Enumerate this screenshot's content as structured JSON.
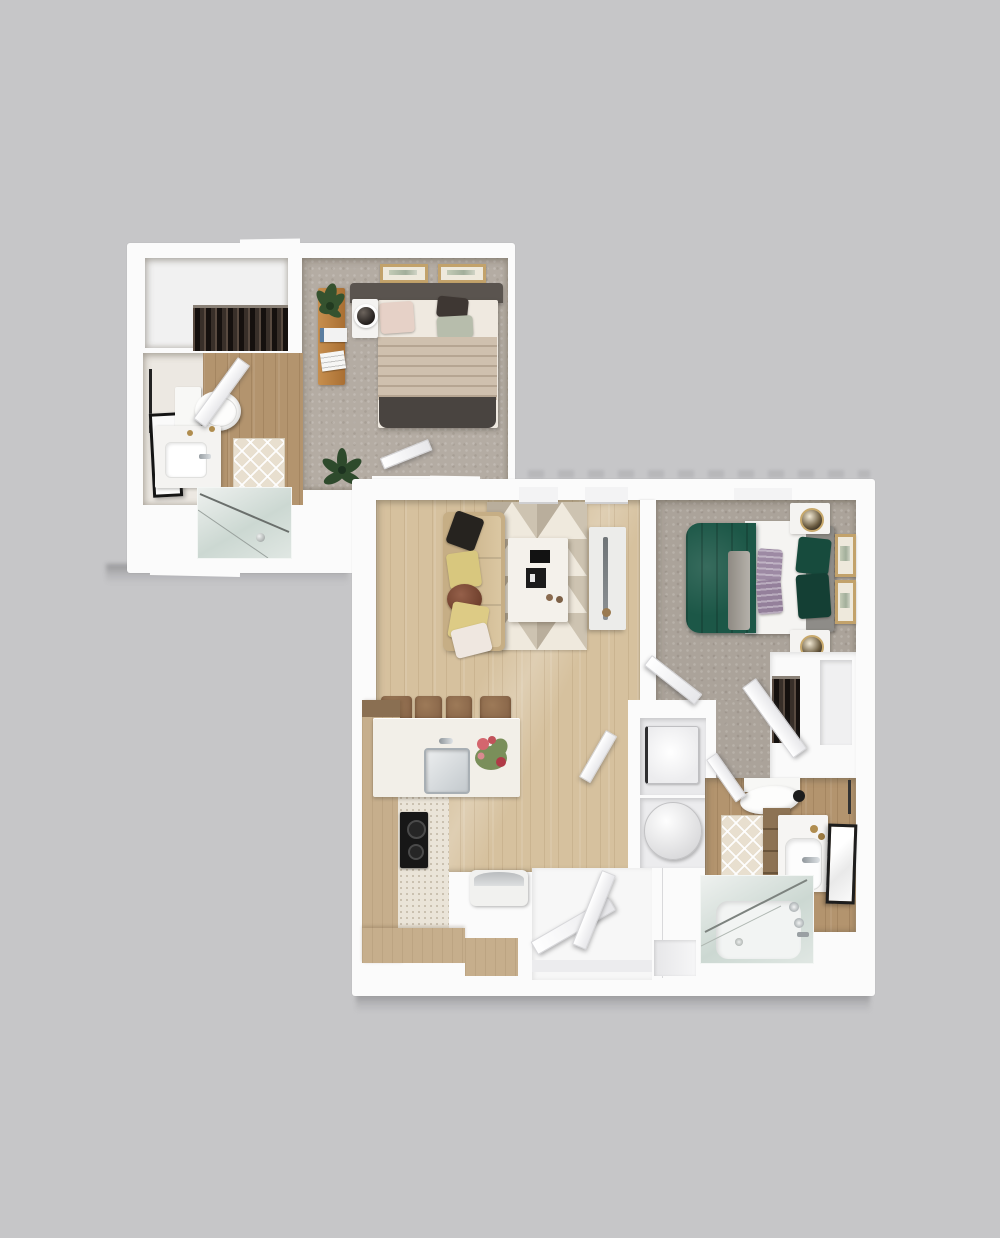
{
  "scene": {
    "type": "3d-floor-plan-render",
    "orientation": "top-down",
    "text_visible": "none"
  },
  "colors": {
    "background": "#c6c6c8",
    "wall": "#fbfbfb",
    "carpet-1": "#b4aca3",
    "carpet-2": "#aba39a",
    "wood-living": "#d6c19e",
    "wood-bath": "#b3946e",
    "cabinet-tan": "#c6ae8c",
    "counter-white": "#f2efe8",
    "sofa-beige": "#c6ae85",
    "rug-base": "#ded5c5",
    "bed1-blanket": "#cfc0ae",
    "bed1-footer": "#494440",
    "headboard-1": "#5a544f",
    "bed2-green": "#1c5747",
    "headboard-2": "#8e8c88",
    "pillow-purple": "#9d8aa4",
    "frame-tan": "#c2a26b",
    "stool-brown": "#8a674a",
    "glass-tint": "#ccd8d2",
    "drop-shadow": "#8f8f91"
  },
  "units": [
    {
      "name": "upper-left-unit",
      "rooms": [
        {
          "name": "walk-in-closet",
          "furniture": [
            "clothes-rack"
          ]
        },
        {
          "name": "bathroom-1",
          "furniture": [
            "towel-bar",
            "leaning-mirror",
            "toilet",
            "vanity-sink",
            "bath-mat",
            "swing-door"
          ]
        },
        {
          "name": "shower-room",
          "furniture": [
            "glass-shower"
          ]
        },
        {
          "name": "bedroom-1",
          "floor": "carpet",
          "furniture": [
            "wall-art",
            "wall-art",
            "headboard",
            "double-bed",
            "throw-pillows",
            "nightstand",
            "table-lamp",
            "console-table",
            "potted-plant",
            "books",
            "floor-plant",
            "swing-door"
          ]
        }
      ]
    },
    {
      "name": "lower-right-unit",
      "rooms": [
        {
          "name": "living-room",
          "floor": "hardwood",
          "furniture": [
            "window",
            "window",
            "sectional-sofa",
            "throw-pillows",
            "geometric-area-rug",
            "coffee-table",
            "decor-books",
            "tv-console",
            "tv"
          ]
        },
        {
          "name": "kitchen",
          "furniture": [
            "bar-stool",
            "bar-stool",
            "bar-stool",
            "bar-stool",
            "island-counter",
            "kitchen-sink",
            "flower-vase",
            "cooktop",
            "base-cabinets",
            "bench"
          ]
        },
        {
          "name": "bedroom-2",
          "floor": "carpet",
          "furniture": [
            "window",
            "double-bed-green",
            "gray-headboard",
            "purple-pillows",
            "nightstand",
            "nightstand",
            "table-lamp",
            "table-lamp",
            "wall-art",
            "wall-art",
            "swing-door"
          ]
        },
        {
          "name": "bedroom-2-closet",
          "furniture": [
            "clothes-rack",
            "shelf-recess",
            "swing-door"
          ]
        },
        {
          "name": "laundry-closet",
          "furniture": [
            "washer",
            "round-unit",
            "swing-door"
          ]
        },
        {
          "name": "bathroom-2",
          "furniture": [
            "toilet",
            "wood-vanity",
            "sink-counter",
            "wall-mirror",
            "bath-mat",
            "glass-bathtub",
            "swing-door"
          ]
        },
        {
          "name": "entry",
          "furniture": [
            "entry-door",
            "entry-door"
          ]
        }
      ]
    }
  ]
}
